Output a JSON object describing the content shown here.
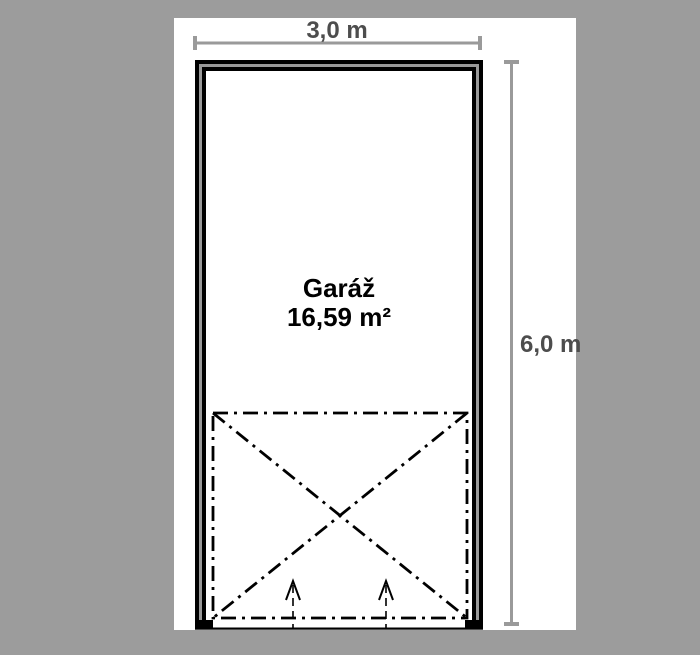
{
  "colors": {
    "background": "#9c9c9c",
    "paper": "#ffffff",
    "wall": "#000000",
    "wall_core": "#999999",
    "dimension": "#9a9a9a",
    "dimension_text": "#4d4d4d",
    "label_text": "#000000"
  },
  "dimensions": {
    "width_label": "3,0 m",
    "height_label": "6,0 m"
  },
  "room": {
    "name": "Garáž",
    "area": "16,59 m²"
  }
}
